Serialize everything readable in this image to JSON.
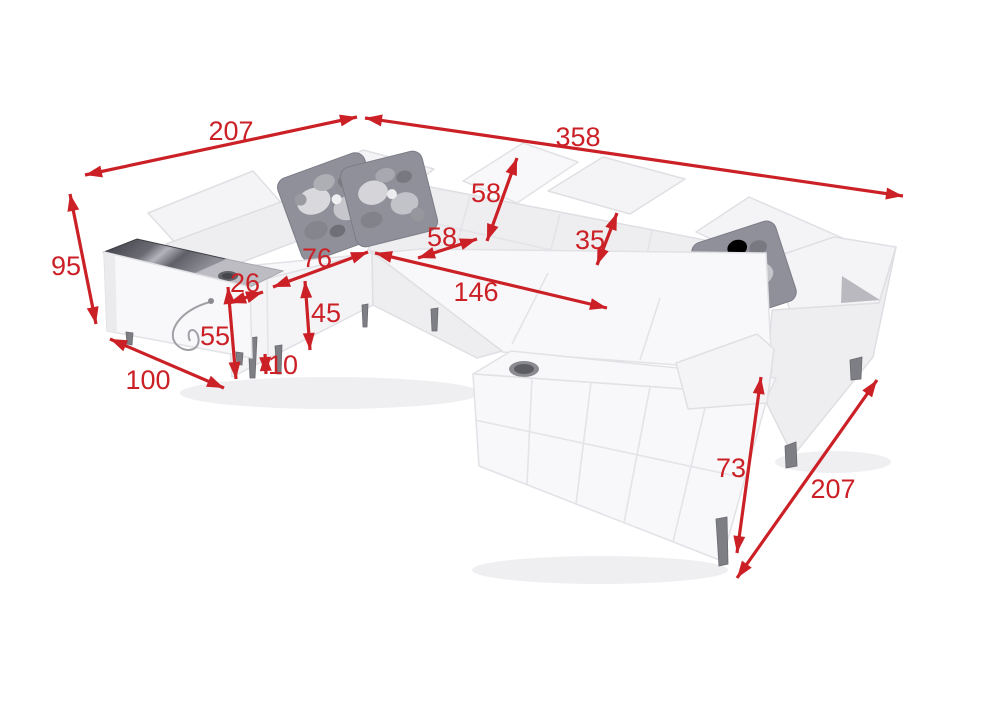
{
  "meta": {
    "diagram_type": "furniture-dimension-diagram",
    "subject": "u-shaped-corner-sofa",
    "background_color": "#ffffff",
    "dimension_color": "#cb2026",
    "sofa_body_color": "#f4f4f6",
    "glass_table_color": "#4a4a52",
    "pillow_color": "#90909a"
  },
  "dimensions": [
    {
      "name": "left-section-length",
      "value": "207",
      "line": [
        85,
        175,
        357,
        117
      ],
      "label": [
        231,
        131
      ]
    },
    {
      "name": "back-section-length",
      "value": "358",
      "line": [
        365,
        118,
        903,
        196
      ],
      "label": [
        578,
        137
      ]
    },
    {
      "name": "overall-height",
      "value": "95",
      "line": [
        70,
        194,
        96,
        324
      ],
      "label": [
        66,
        266
      ]
    },
    {
      "name": "left-end-depth",
      "value": "100",
      "line": [
        110,
        339,
        224,
        388
      ],
      "label": [
        148,
        380
      ]
    },
    {
      "name": "armrest-top-width",
      "value": "26",
      "line": [
        229,
        303,
        263,
        292
      ],
      "label": [
        245,
        283
      ]
    },
    {
      "name": "armrest-height",
      "value": "55",
      "line": [
        228,
        287,
        236,
        379
      ],
      "label": [
        215,
        336
      ]
    },
    {
      "name": "leg-height",
      "value": "10",
      "line": [
        265,
        354,
        266,
        374
      ],
      "label": [
        283,
        365
      ]
    },
    {
      "name": "seat-depth-left",
      "value": "76",
      "line": [
        273,
        287,
        368,
        252
      ],
      "label": [
        317,
        258
      ]
    },
    {
      "name": "seat-height",
      "value": "45",
      "line": [
        305,
        281,
        310,
        350
      ],
      "label": [
        326,
        313
      ]
    },
    {
      "name": "backrest-height",
      "value": "58",
      "line": [
        487,
        241,
        517,
        158
      ],
      "label": [
        486,
        193
      ]
    },
    {
      "name": "seat-depth-back",
      "value": "58",
      "line": [
        418,
        258,
        477,
        239
      ],
      "label": [
        442,
        237
      ]
    },
    {
      "name": "headrest-height",
      "value": "35",
      "line": [
        597,
        265,
        617,
        213
      ],
      "label": [
        590,
        240
      ]
    },
    {
      "name": "sleeping-area-width",
      "value": "146",
      "line": [
        375,
        253,
        607,
        308
      ],
      "label": [
        476,
        292
      ]
    },
    {
      "name": "chaise-height",
      "value": "73",
      "line": [
        761,
        377,
        737,
        553
      ],
      "label": [
        731,
        468
      ]
    },
    {
      "name": "right-section-depth",
      "value": "207",
      "line": [
        737,
        578,
        877,
        380
      ],
      "label": [
        833,
        489
      ]
    }
  ]
}
